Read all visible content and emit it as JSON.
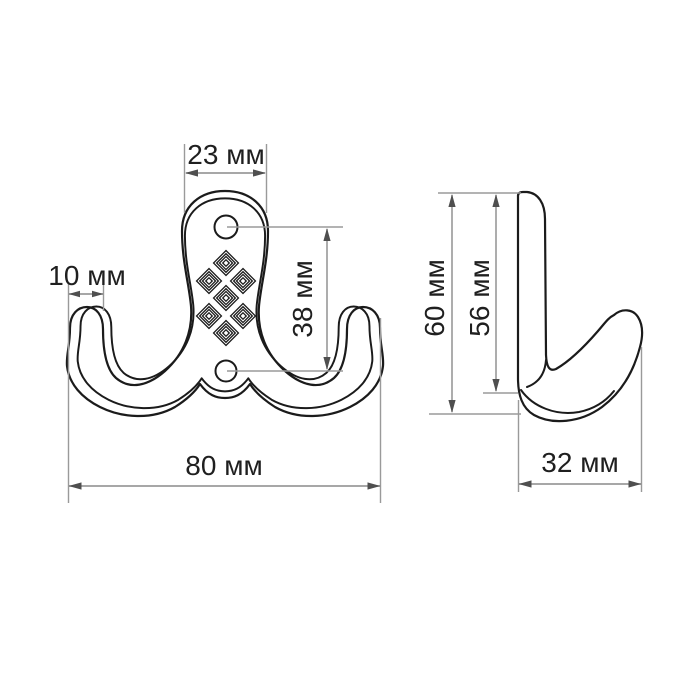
{
  "drawing": {
    "type": "technical-dimension-drawing",
    "unit": "мм",
    "front_view": {
      "plate_width_label": "23 мм",
      "tip_width_label": "10 мм",
      "hole_spacing_label": "38 мм",
      "total_width_label": "80 мм",
      "screw_holes": 2,
      "ornament": "diamond-lattice-7"
    },
    "side_view": {
      "total_height_label": "60 мм",
      "inner_height_label": "56 мм",
      "depth_label": "32 мм"
    },
    "colors": {
      "outline": "#1b1b1b",
      "dimension_line": "#8a8a8a",
      "extension_line": "#9a9a9a",
      "arrow": "#4f4f4f",
      "label_text": "#1f1f1f",
      "background": "#ffffff"
    }
  }
}
